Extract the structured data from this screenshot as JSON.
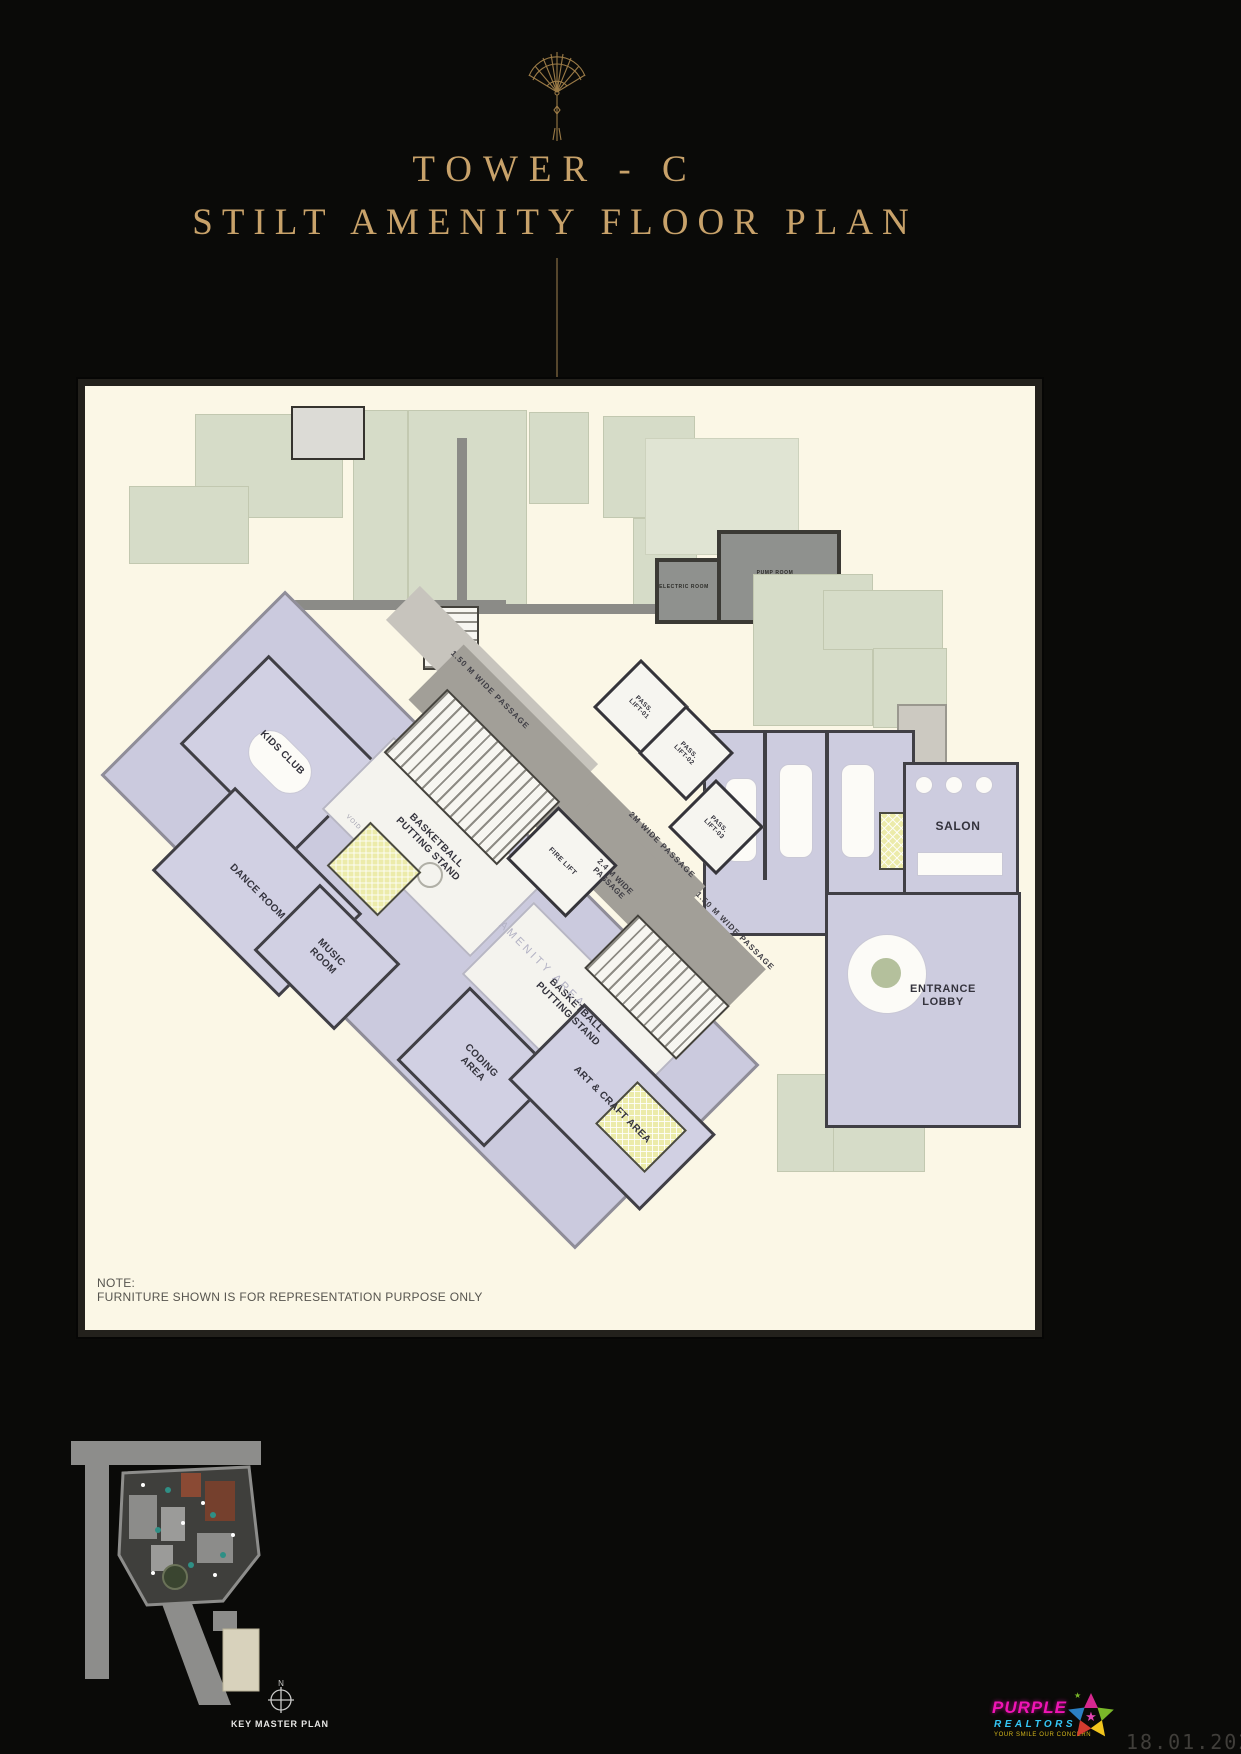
{
  "header": {
    "ornament_icon": "folding-fan",
    "title_line1": "TOWER - C",
    "title_line2": "STILT AMENITY FLOOR PLAN"
  },
  "plan": {
    "rooms": {
      "kids_club": "KIDS CLUB",
      "dance_room": "DANCE ROOM",
      "music_room": "MUSIC ROOM",
      "basketball_putting_stand_1": "BASKETBALL PUTTING STAND",
      "basketball_putting_stand_2": "BASKETBALL PUTTING STAND",
      "coding_area": "CODING AREA",
      "art_craft_area": "ART & CRAFT AREA",
      "amenity_area": "AMENITY AREA",
      "void": "VOID",
      "spa": "SPA",
      "salon": "SALON",
      "entrance_lobby": "ENTRANCE LOBBY",
      "electric_room": "ELECTRIC ROOM",
      "pump_room": "PUMP ROOM"
    },
    "lifts": {
      "fire_lift": "FIRE LIFT",
      "pass_lift_01": "PASS. LIFT-01",
      "pass_lift_02": "PASS. LIFT-02",
      "pass_lift_03": "PASS. LIFT-03"
    },
    "passages": {
      "passage_150_top": "1.50 M WIDE PASSAGE",
      "passage_2m": "2M WIDE PASSAGE",
      "passage_24": "2.4 M WIDE PASSAGE",
      "passage_150_right": "1.50 M WIDE PASSAGE"
    },
    "note": {
      "title": "NOTE:",
      "body": "FURNITURE SHOWN IS FOR REPRESENTATION PURPOSE ONLY"
    }
  },
  "footer": {
    "north_label": "N",
    "key_plan_caption": "KEY MASTER PLAN",
    "logo": {
      "name": "PURPLE",
      "name2": "REALTORS",
      "tagline": "YOUR SMILE OUR CONCERN"
    },
    "date": "18.01.2026"
  },
  "colors": {
    "background": "#0a0a08",
    "title_gold": "#c8a26a",
    "plan_paper": "#fbf7e6",
    "amenity_lavender": "#cdccdf",
    "landscape_sage": "#d6dcc8",
    "passage_gray": "#a29f98",
    "toilet_yellow": "#ecebaa",
    "logo_magenta": "#f014b4",
    "logo_cyan": "#35c7f6",
    "logo_yellow": "#d4b61c"
  }
}
